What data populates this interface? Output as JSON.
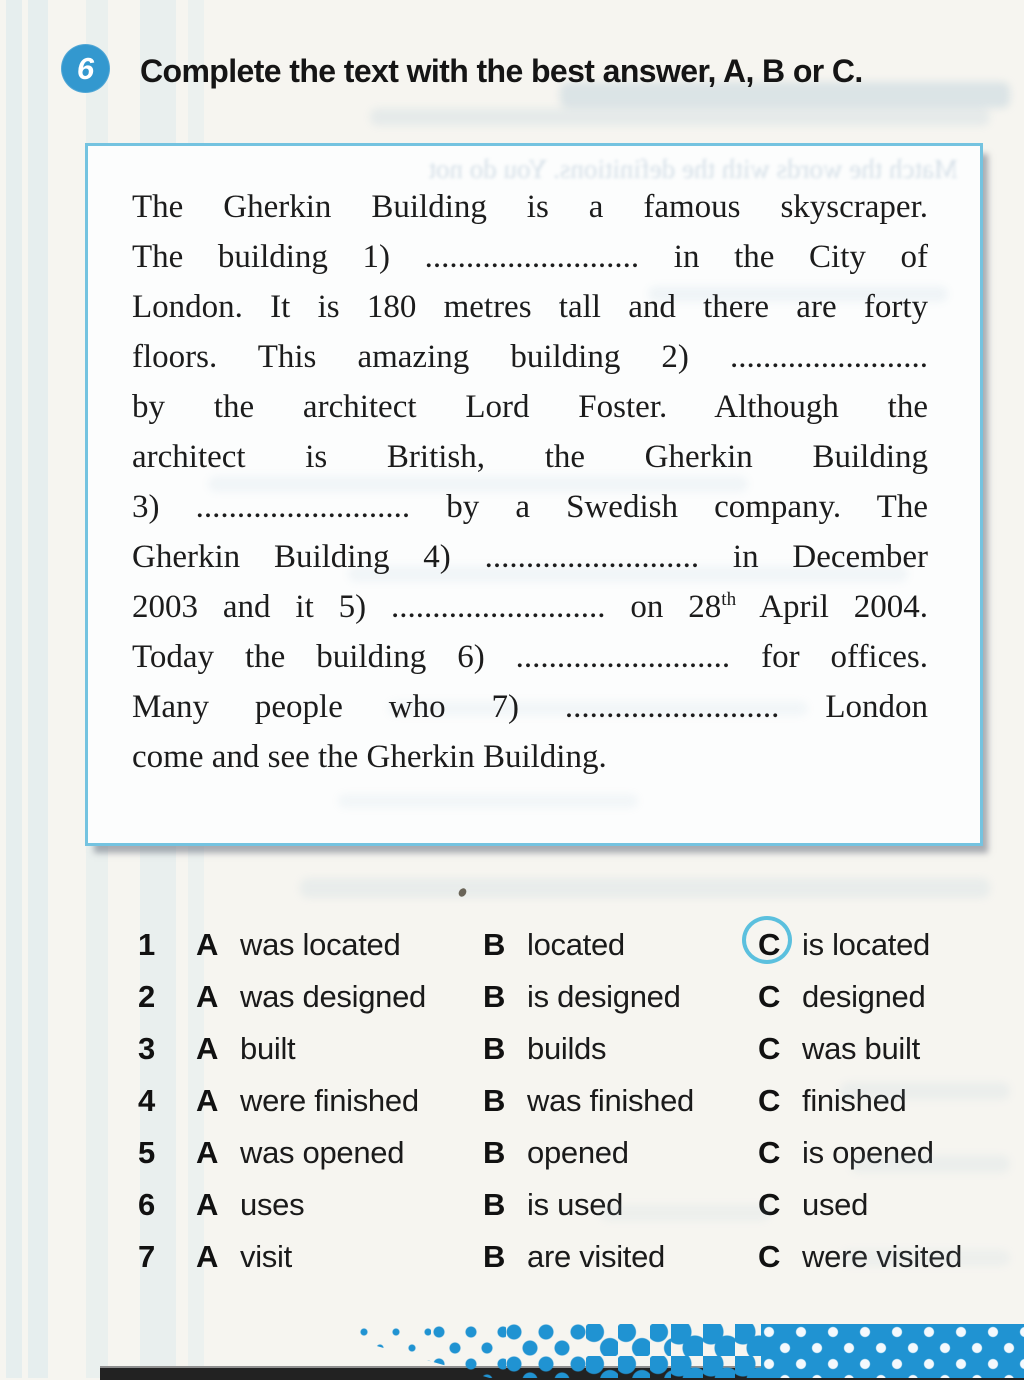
{
  "header": {
    "number": "6",
    "title": "Complete the text with the best answer, A, B or C."
  },
  "passage": {
    "lines": [
      {
        "text": "The Gherkin Building is a famous skyscraper."
      },
      {
        "text": "The building 1) .......................... in the City of"
      },
      {
        "text": "London. It is 180 metres tall and there are forty"
      },
      {
        "text": "floors. This amazing building 2) ........................"
      },
      {
        "text": "by the architect Lord Foster. Although the"
      },
      {
        "text": "architect is British, the Gherkin Building"
      },
      {
        "text": "3) .......................... by a Swedish company. The"
      },
      {
        "text": "Gherkin Building 4) .......................... in December"
      },
      {
        "pre": "2003 and it 5) .......................... on 28",
        "sup": "th",
        "post": " April 2004."
      },
      {
        "text": "Today the building 6) .......................... for offices."
      },
      {
        "text": "Many people who 7) .......................... London"
      },
      {
        "text": "come and see the Gherkin Building."
      }
    ]
  },
  "options": {
    "letters": {
      "a": "A",
      "b": "B",
      "c": "C"
    },
    "rows": [
      {
        "num": "1",
        "a": "was located",
        "b": "located",
        "c": "is located",
        "circled": "C"
      },
      {
        "num": "2",
        "a": "was designed",
        "b": "is designed",
        "c": "designed"
      },
      {
        "num": "3",
        "a": "built",
        "b": "builds",
        "c": "was built"
      },
      {
        "num": "4",
        "a": "were finished",
        "b": "was finished",
        "c": "finished"
      },
      {
        "num": "5",
        "a": "was opened",
        "b": "opened",
        "c": "is opened"
      },
      {
        "num": "6",
        "a": "uses",
        "b": "is used",
        "c": "used"
      },
      {
        "num": "7",
        "a": "visit",
        "b": "are visited",
        "c": "were visited"
      }
    ]
  },
  "ghost": {
    "show_through_line": "Match the words with the definitions. You do not"
  },
  "colors": {
    "badge_blue": "#3398cf",
    "box_border": "#74c3e0",
    "answer_ring": "#5bc0de",
    "halftone_blue": "#2093d2",
    "page_background": "#f6f5f0"
  }
}
